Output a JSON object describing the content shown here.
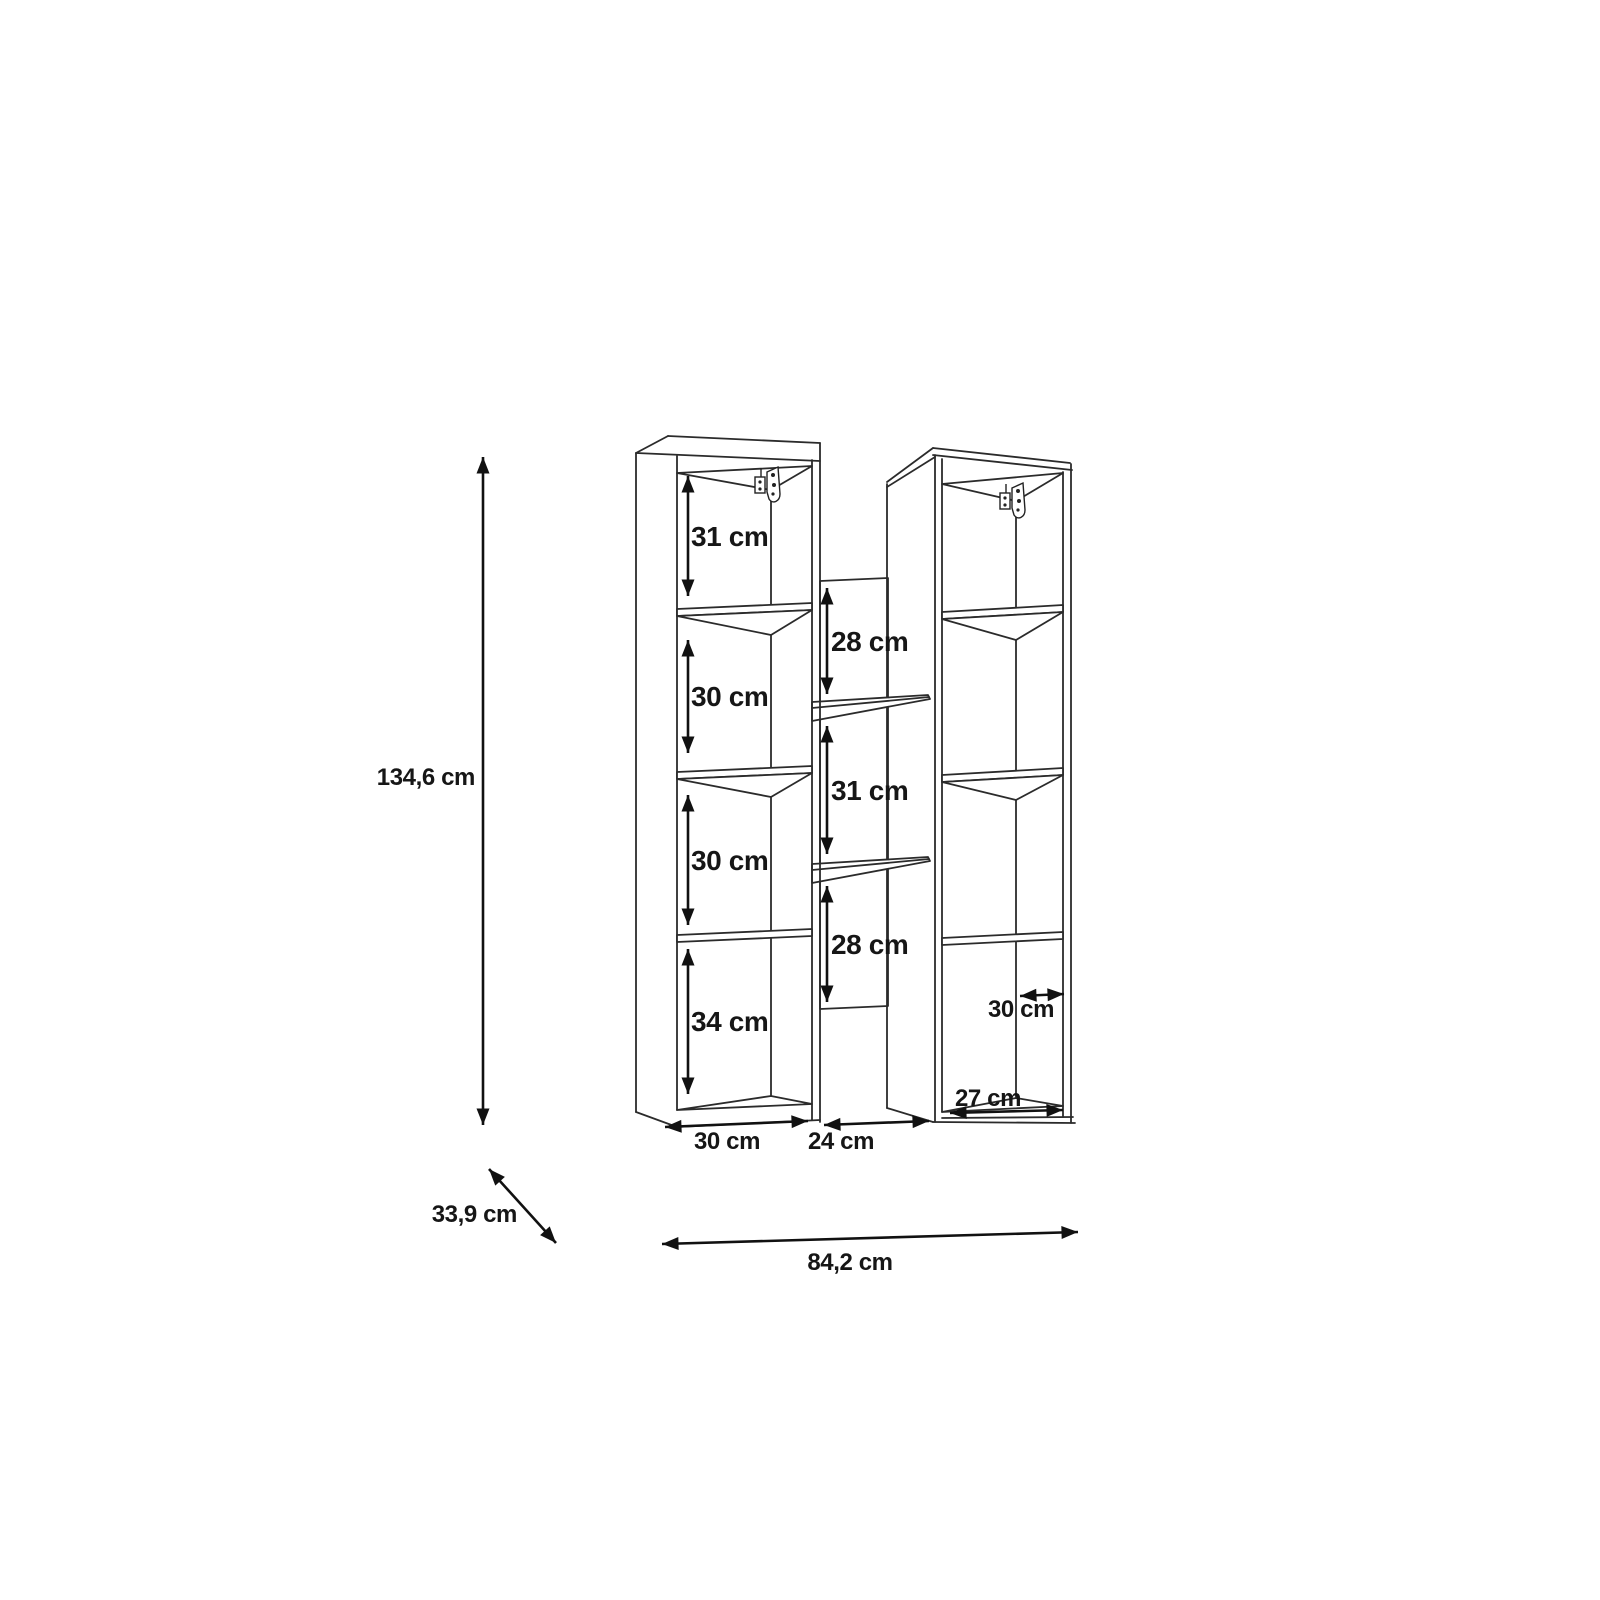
{
  "dims": {
    "total_height": "134,6 cm",
    "total_width": "84,2 cm",
    "total_depth": "33,9 cm",
    "left": {
      "cells": [
        "31 cm",
        "30 cm",
        "30 cm",
        "34 cm"
      ],
      "width": "30 cm"
    },
    "middle": {
      "cells": [
        "28 cm",
        "31 cm",
        "28 cm"
      ],
      "width": "24 cm"
    },
    "right": {
      "depth": "30 cm",
      "width": "27 cm"
    }
  }
}
